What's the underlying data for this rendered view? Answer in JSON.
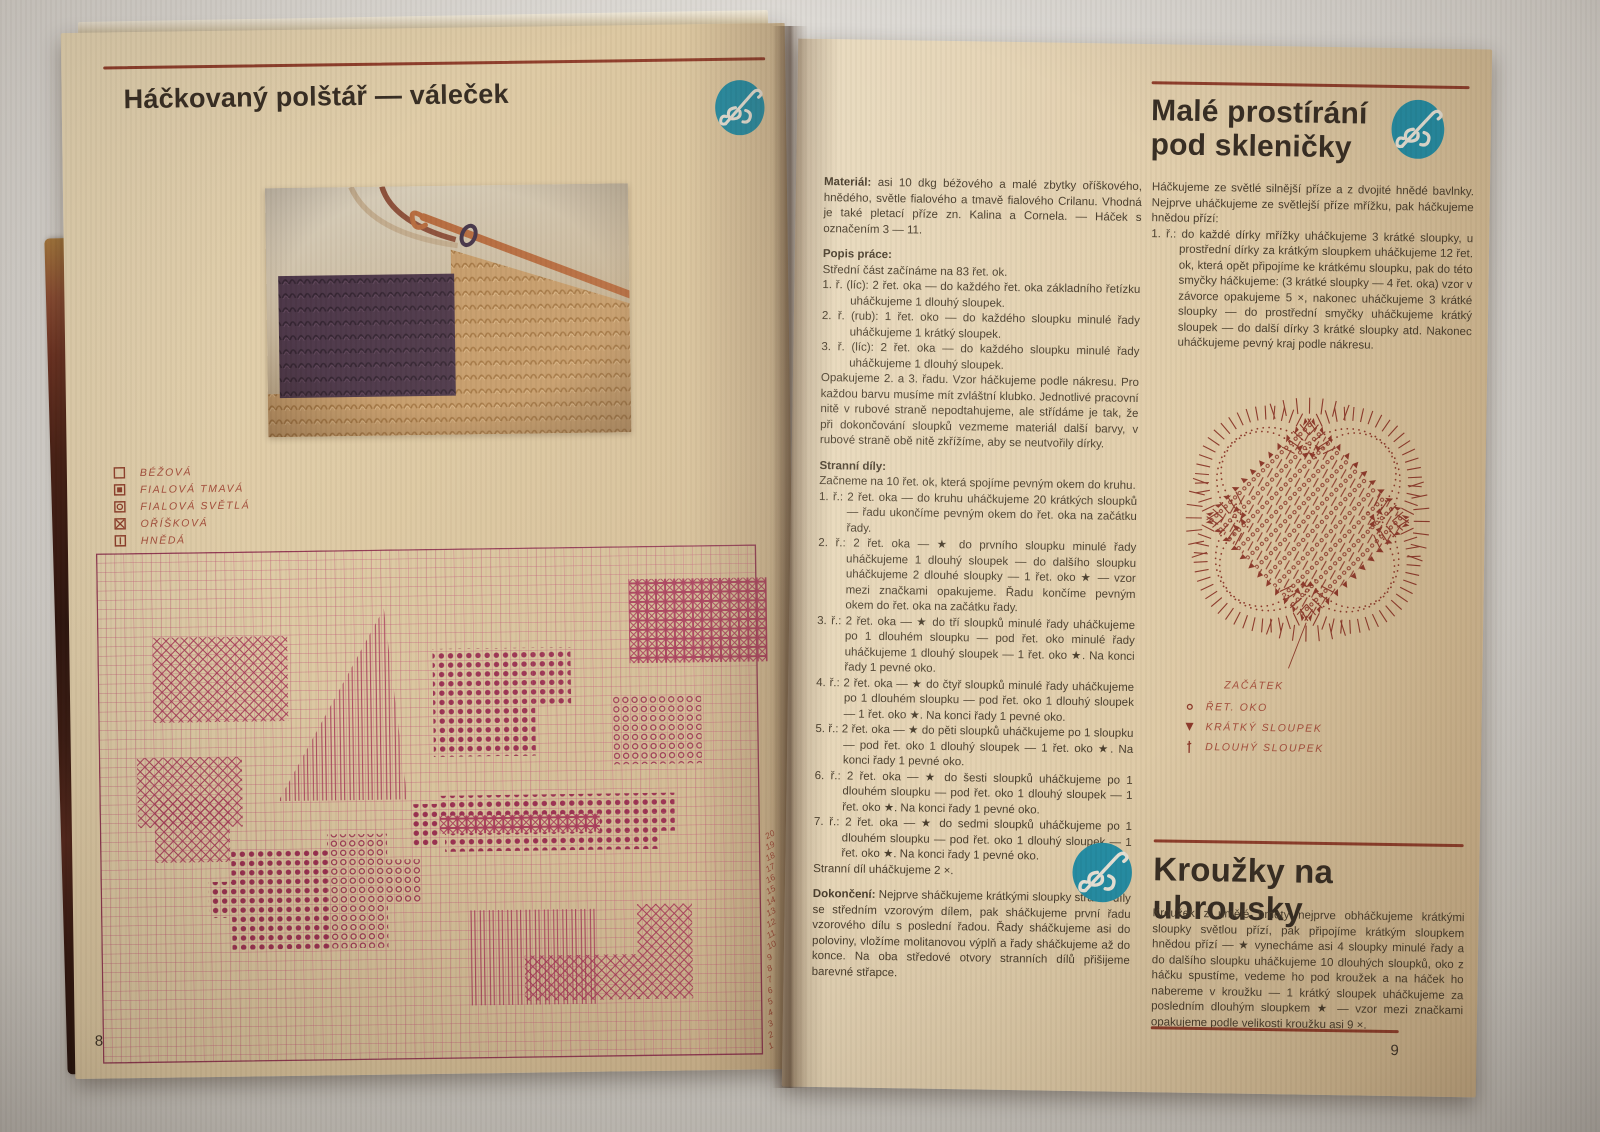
{
  "colors": {
    "accent_rule": "#8d3a27",
    "handwriting": "#a34a38",
    "grid_line": "#c4607a",
    "grid_symbol": "#a83a58",
    "grid_symbol_dark": "#992c4e",
    "grid_border": "#8f3550",
    "diagram_ink": "#8a3526",
    "logo_teal": "#1f8ba3",
    "body_text": "#443827"
  },
  "left_page": {
    "page_number": "8",
    "title": "Háčkovaný polštář — váleček",
    "legend": [
      {
        "symbol": "empty-square",
        "label": "BÉŽOVÁ"
      },
      {
        "symbol": "filled-square",
        "label": "FIALOVÁ TMAVÁ"
      },
      {
        "symbol": "circle-square",
        "label": "FIALOVÁ SVĚTLÁ"
      },
      {
        "symbol": "cross-square",
        "label": "OŘÍŠKOVÁ"
      },
      {
        "symbol": "bar-square",
        "label": "HNĚDÁ"
      }
    ],
    "chart": {
      "type": "crochet-colorwork-grid",
      "row_labels": [
        "20",
        "19",
        "18",
        "17",
        "16",
        "15",
        "14",
        "13",
        "12",
        "11",
        "10",
        "9",
        "8",
        "7",
        "6",
        "5",
        "4",
        "3",
        "2",
        "1"
      ],
      "regions": [
        {
          "type": "xhatch",
          "x": 55,
          "y": 85,
          "w": 135,
          "h": 85
        },
        {
          "type": "vlines",
          "poly": "287,59 308,250 179,250"
        },
        {
          "type": "dots",
          "x": 335,
          "y": 100,
          "w": 100,
          "h": 108
        },
        {
          "type": "dots",
          "x": 435,
          "y": 100,
          "w": 38,
          "h": 58
        },
        {
          "type": "dots",
          "x": 415,
          "y": 158,
          "w": 22,
          "h": 50
        },
        {
          "type": "xbox",
          "x": 532,
          "y": 33,
          "w": 138,
          "h": 84
        },
        {
          "type": "circles",
          "x": 515,
          "y": 148,
          "w": 88,
          "h": 70
        },
        {
          "type": "xhatch",
          "x": 38,
          "y": 205,
          "w": 105,
          "h": 70
        },
        {
          "type": "xhatch",
          "x": 55,
          "y": 245,
          "w": 75,
          "h": 65
        },
        {
          "type": "dots",
          "x": 131,
          "y": 298,
          "w": 96,
          "h": 100
        },
        {
          "type": "dots",
          "x": 108,
          "y": 330,
          "w": 24,
          "h": 36
        },
        {
          "type": "circles",
          "x": 227,
          "y": 284,
          "w": 60,
          "h": 114
        },
        {
          "type": "circles",
          "x": 287,
          "y": 310,
          "w": 35,
          "h": 45
        },
        {
          "type": "dots",
          "x": 340,
          "y": 247,
          "w": 235,
          "h": 20
        },
        {
          "type": "xbox",
          "x": 340,
          "y": 267,
          "w": 160,
          "h": 18
        },
        {
          "type": "dots",
          "x": 500,
          "y": 267,
          "w": 75,
          "h": 18
        },
        {
          "type": "dots",
          "x": 345,
          "y": 285,
          "w": 215,
          "h": 18
        },
        {
          "type": "dots",
          "x": 310,
          "y": 255,
          "w": 30,
          "h": 42
        },
        {
          "type": "vlines",
          "x": 366,
          "y": 362,
          "w": 130,
          "h": 95
        },
        {
          "type": "xhatch",
          "x": 536,
          "y": 358,
          "w": 55,
          "h": 95
        },
        {
          "type": "xhatch",
          "x": 423,
          "y": 408,
          "w": 115,
          "h": 45
        }
      ]
    }
  },
  "right_page": {
    "page_number": "9",
    "materials": {
      "lead": "Materiál:",
      "text": "asi 10 dkg béžového a malé zbytky oříškového, hnědého, světle fialového a tmavě fialového Crilanu. Vhodná je také pletací příze zn. Kalina a Cornela. — Háček s označením 3 — 11."
    },
    "popis_heading": "Popis práce:",
    "popis_intro": "Střední část začínáme na 83 řet. ok.",
    "popis_items": [
      "1. ř. (líc): 2 řet. oka — do každého řet. oka základního řetízku uháčkujeme 1 dlouhý sloupek.",
      "2. ř. (rub): 1 řet. oko — do každého sloupku minulé řady uháčkujeme 1 krátký sloupek.",
      "3. ř. (líc): 2 řet. oka — do každého sloupku minulé řady uháčkujeme 1 dlouhý sloupek."
    ],
    "popis_outro": "Opakujeme 2. a 3. řadu. Vzor háčkujeme podle nákresu. Pro každou barvu musíme mít zvláštní klubko. Jednotlivé pracovní nitě v rubové straně nepodtahujeme, ale střídáme je tak, že při dokončování sloupků vezmeme materiál další barvy, v rubové straně obě nitě zkřížíme, aby se neutvořily dírky.",
    "stranni_heading": "Stranní díly:",
    "stranni_intro": "Začneme na 10 řet. ok, která spojíme pevným okem do kruhu.",
    "stranni_items": [
      "1. ř.: 2 řet. oka — do kruhu uháčkujeme 20 krátkých sloupků — řadu ukončíme pevným okem do řet. oka na začátku řady.",
      "2. ř.: 2 řet. oka — ★ do prvního sloupku minulé řady uháčkujeme 1 dlouhý sloupek — do dalšího sloupku uháčkujeme 2 dlouhé sloupky — 1 řet. oko ★ — vzor mezi značkami opakujeme. Řadu končíme pevným okem do řet. oka na začátku řady.",
      "3. ř.: 2 řet. oka — ★ do tří sloupků minulé řady uháčkujeme po 1 dlouhém sloupku — pod řet. oko minulé řady uháčkujeme 1 dlouhý sloupek — 1 řet. oko ★. Na konci řady 1 pevné oko.",
      "4. ř.: 2 řet. oka — ★ do čtyř sloupků minulé řady uháčkujeme po 1 dlouhém sloupku — pod řet. oko 1 dlouhý sloupek — 1 řet. oko ★. Na konci řady 1 pevné oko.",
      "5. ř.: 2 řet. oka — ★ do pěti sloupků uháčkujeme po 1 sloupku — pod řet. oko 1 dlouhý sloupek — 1 řet. oko ★. Na konci řady 1 pevné oko.",
      "6. ř.: 2 řet. oka — ★ do šesti sloupků uháčkujeme po 1 dlouhém sloupku — pod řet. oko 1 dlouhý sloupek — 1 řet. oko ★. Na konci řady 1 pevné oko.",
      "7. ř.: 2 řet. oka — ★ do sedmi sloupků uháčkujeme po 1 dlouhém sloupku — pod řet. oko 1 dlouhý sloupek — 1 řet. oko ★. Na konci řady 1 pevné oko."
    ],
    "stranni_outro": "Stranní díl uháčkujeme 2 ×.",
    "finishing": {
      "lead": "Dokončení:",
      "text": "Nejprve sháčkujeme krátkými sloupky stranní díly se středním vzorovým dílem, pak sháčkujeme první řadu vzorového dílu s poslední řadou. Řady sháčkujeme asi do poloviny, vložíme molitanovou výplň a řady sháčkujeme až do konce. Na oba středové otvory stranních dílů přišijeme barevné střapce."
    },
    "article_title_line1": "Malé prostírání",
    "article_title_line2": "pod skleničky",
    "article_intro": "Háčkujeme ze světlé silnější příze a z dvojité hnědé bavlnky. Nejprve uháčkujeme ze světlejší příze mřížku, pak háčkujeme hnědou přízí:",
    "article_item": "1. ř.: do každé dírky mřížky uháčkujeme 3 krátké sloupky, u prostřední dírky za krátkým sloupkem uháčkujeme 12 řet. ok, která opět připojíme ke krátkému sloupku, pak do této smyčky háčkujeme: (3 krátké sloupky — 4 řet. oka) vzor v závorce opakujeme 5 ×, nakonec uháčkujeme 3 krátké sloupky — do prostřední smyčky uháčkujeme krátký sloupek — do další dírky 3 krátké sloupky atd. Nakonec uháčkujeme pevný kraj podle nákresu.",
    "diagram_start_label": "ZAČÁTEK",
    "diagram_legend": [
      {
        "symbol": "chain-circle",
        "label": "ŘET. OKO"
      },
      {
        "symbol": "triangle",
        "label": "KRÁTKÝ SLOUPEK"
      },
      {
        "symbol": "bar",
        "label": "DLOUHÝ SLOUPEK"
      }
    ],
    "section2_title": "Kroužky na ubrousky",
    "section2_text": "Kroužek z umělé hmoty nejprve obháčkujeme krátkými sloupky světlou přízí, pak připojíme krátkým sloupkem hnědou přízí — ★ vynecháme asi 4 sloupky minulé řady a do dalšího sloupku uháčkujeme 10 dlouhých sloupků, oko z háčku spustíme, vedeme ho pod kroužek a na háček ho nabereme v kroužku — 1 krátký sloupek uháčkujeme za posledním dlouhým sloupkem ★ — vzor mezi značkami opakujeme podle velikosti kroužku asi 9 ×."
  }
}
